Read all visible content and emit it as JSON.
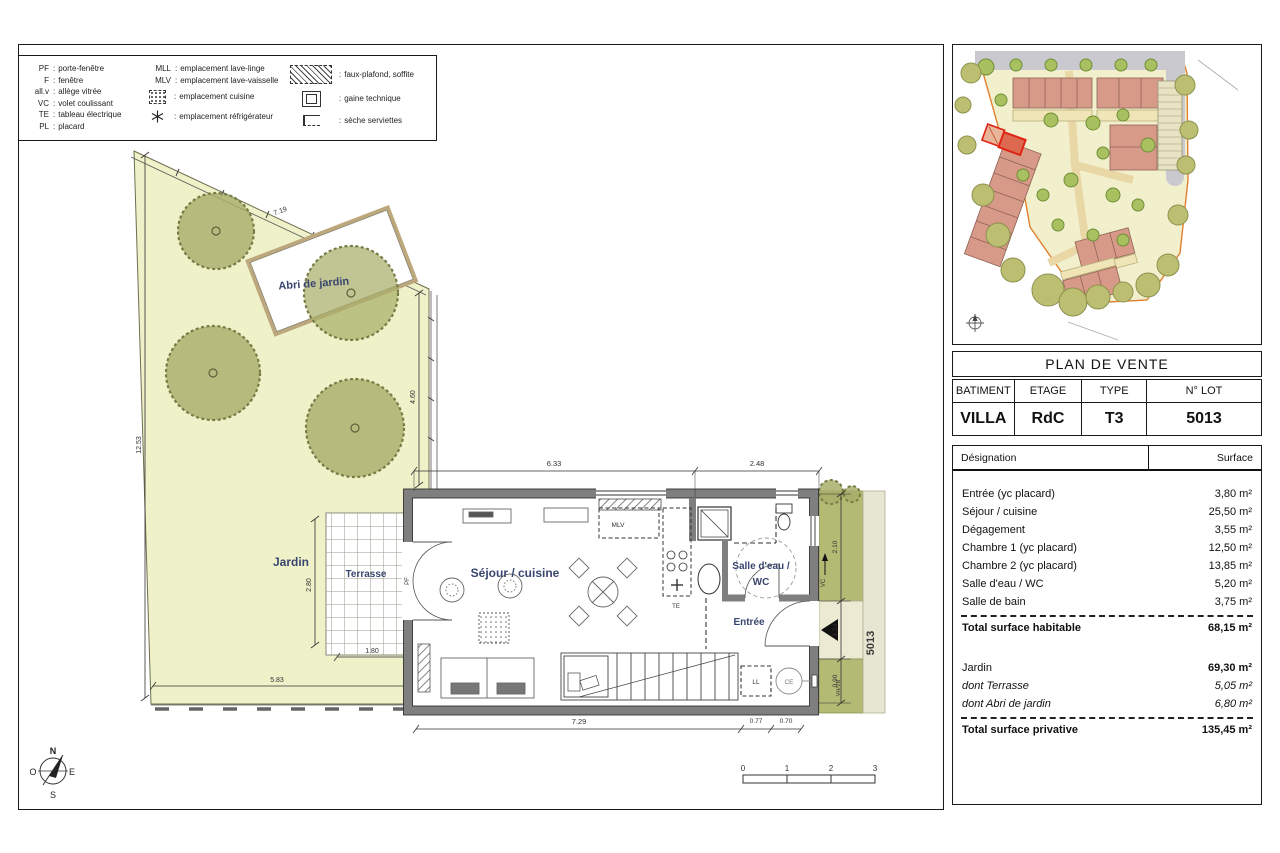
{
  "colors": {
    "label_navy": "#39466f",
    "garden_fill": "#eff1c9",
    "tree_olive": "#a8ae6a",
    "wall_gray": "#7f7f7f",
    "strip_olive": "#b2ba74",
    "site_building": "#d79a89",
    "site_road": "#c9c9cf",
    "site_boundary_orange": "#e0802f",
    "highlight_red": "#e02414"
  },
  "legend": {
    "col1": [
      {
        "abbr": "PF",
        "label": "porte-fenêtre"
      },
      {
        "abbr": "F",
        "label": "fenêtre"
      },
      {
        "abbr": "all.v",
        "label": "allège vitrée"
      },
      {
        "abbr": "VC",
        "label": "volet coulissant"
      },
      {
        "abbr": "TE",
        "label": "tableau électrique"
      },
      {
        "abbr": "PL",
        "label": "placard"
      }
    ],
    "col2": [
      {
        "abbr": "MLL",
        "label": "emplacement lave-linge"
      },
      {
        "abbr": "MLV",
        "label": "emplacement lave-vaisselle"
      },
      {
        "label": "emplacement cuisine"
      },
      {
        "label": "emplacement réfrigérateur"
      }
    ],
    "col3": [
      {
        "label": "faux-plafond, soffite"
      },
      {
        "label": "gaine technique"
      },
      {
        "label": "sèche serviettes"
      }
    ]
  },
  "plan": {
    "labels": [
      "Abri de jardin",
      "Jardin",
      "Terrasse",
      "Séjour / cuisine",
      "Salle d'eau /",
      "WC",
      "Entrée"
    ],
    "tags": [
      "MLV",
      "TE",
      "LL",
      "CE",
      "VH/VB",
      "5013",
      "PF",
      "VC"
    ],
    "dims": [
      "7.19",
      "12.53",
      "4.60",
      "5.83",
      "2.80",
      "1.80",
      "6.33",
      "2.48",
      "7.29",
      "0.77",
      "0.70",
      "2.10",
      "1.24",
      "0.90"
    ]
  },
  "compass": {
    "n": "N",
    "s": "S",
    "e": "E",
    "o": "O"
  },
  "scale_bar": {
    "ticks": [
      "0",
      "1",
      "2",
      "3"
    ]
  },
  "title_block": {
    "title": "PLAN DE VENTE",
    "headers": [
      "BATIMENT",
      "ETAGE",
      "TYPE",
      "N° LOT"
    ],
    "values": [
      "VILLA",
      "RdC",
      "T3",
      "5013"
    ]
  },
  "surface_table": {
    "designation_header": "Désignation",
    "surface_header": "Surface",
    "rows": [
      {
        "label": "Entrée (yc placard)",
        "value": "3,80 m²"
      },
      {
        "label": "Séjour / cuisine",
        "value": "25,50 m²"
      },
      {
        "label": "Dégagement",
        "value": "3,55 m²"
      },
      {
        "label": "Chambre 1 (yc placard)",
        "value": "12,50 m²"
      },
      {
        "label": "Chambre 2 (yc placard)",
        "value": "13,85 m²"
      },
      {
        "label": "Salle d'eau / WC",
        "value": "5,20 m²"
      },
      {
        "label": "Salle de bain",
        "value": "3,75 m²"
      }
    ],
    "total_habitable": {
      "label": "Total surface habitable",
      "value": "68,15 m²"
    },
    "garden_rows": [
      {
        "label": "Jardin",
        "value": "69,30 m²"
      },
      {
        "label": "dont Terrasse",
        "value": "5,05 m²"
      },
      {
        "label": "dont Abri de jardin",
        "value": "6,80 m²"
      }
    ],
    "total_private": {
      "label": "Total surface privative",
      "value": "135,45 m²"
    }
  }
}
